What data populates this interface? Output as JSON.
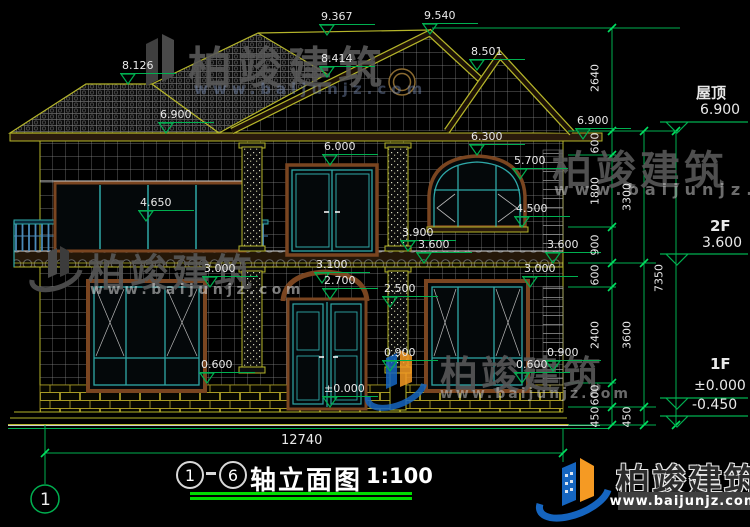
{
  "drawing": {
    "axis_start": "1",
    "axis_end": "6",
    "title": "轴立面图",
    "scale": "1:100",
    "overall_width_mm": "12740",
    "axis_bubble_label": "1"
  },
  "floor_labels": {
    "roof": {
      "name": "屋顶",
      "elev": "6.900"
    },
    "f2": {
      "name": "2F",
      "elev": "3.600"
    },
    "f1": {
      "name": "1F",
      "elev": "±0.000"
    },
    "ground": {
      "elev": "-0.450"
    }
  },
  "elevation_markers": [
    {
      "value": "9.367",
      "x": 327,
      "y": 35
    },
    {
      "value": "9.540",
      "x": 430,
      "y": 34
    },
    {
      "value": "8.414",
      "x": 327,
      "y": 77
    },
    {
      "value": "8.126",
      "x": 128,
      "y": 84
    },
    {
      "value": "8.501",
      "x": 477,
      "y": 70
    },
    {
      "value": "6.900",
      "x": 166,
      "y": 133
    },
    {
      "value": "6.900",
      "x": 583,
      "y": 139
    },
    {
      "value": "6.300",
      "x": 477,
      "y": 155
    },
    {
      "value": "6.000",
      "x": 330,
      "y": 165
    },
    {
      "value": "5.700",
      "x": 520,
      "y": 179
    },
    {
      "value": "4.650",
      "x": 146,
      "y": 221
    },
    {
      "value": "4.500",
      "x": 522,
      "y": 227
    },
    {
      "value": "3.900",
      "x": 408,
      "y": 251
    },
    {
      "value": "3.600",
      "x": 424,
      "y": 263
    },
    {
      "value": "3.600",
      "x": 553,
      "y": 263
    },
    {
      "value": "3.100",
      "x": 322,
      "y": 283
    },
    {
      "value": "3.000",
      "x": 210,
      "y": 287
    },
    {
      "value": "3.000",
      "x": 530,
      "y": 287
    },
    {
      "value": "2.700",
      "x": 330,
      "y": 299
    },
    {
      "value": "2.500",
      "x": 390,
      "y": 307
    },
    {
      "value": "0.900",
      "x": 390,
      "y": 371
    },
    {
      "value": "0.900",
      "x": 553,
      "y": 371
    },
    {
      "value": "0.600",
      "x": 207,
      "y": 383
    },
    {
      "value": "0.600",
      "x": 522,
      "y": 383
    },
    {
      "value": "±0.000",
      "x": 330,
      "y": 407
    }
  ],
  "dimension_chain_texts": [
    {
      "value": "2640",
      "x": 601,
      "y": 78
    },
    {
      "value": "600",
      "x": 601,
      "y": 143
    },
    {
      "value": "1800",
      "x": 601,
      "y": 191
    },
    {
      "value": "900",
      "x": 601,
      "y": 245
    },
    {
      "value": "600",
      "x": 601,
      "y": 275
    },
    {
      "value": "2400",
      "x": 601,
      "y": 335
    },
    {
      "value": "600",
      "x": 601,
      "y": 395
    },
    {
      "value": "450",
      "x": 601,
      "y": 417
    },
    {
      "value": "3300",
      "x": 633,
      "y": 197
    },
    {
      "value": "3600",
      "x": 633,
      "y": 335
    },
    {
      "value": "450",
      "x": 633,
      "y": 417
    },
    {
      "value": "7350",
      "x": 665,
      "y": 278
    }
  ],
  "watermark": {
    "brand": "柏竣建筑",
    "site": "www.baijunjz.com"
  },
  "colors": {
    "dim_green": "#00b050",
    "underline_green": "#00dd00",
    "line_yellow": "#b5b52a",
    "frame_brown": "#7a4520",
    "sash_cyan": "#2fa8a8",
    "text_white": "#e9e9e9",
    "brand_blue": "#1565c0",
    "brand_orange": "#f59a23"
  }
}
